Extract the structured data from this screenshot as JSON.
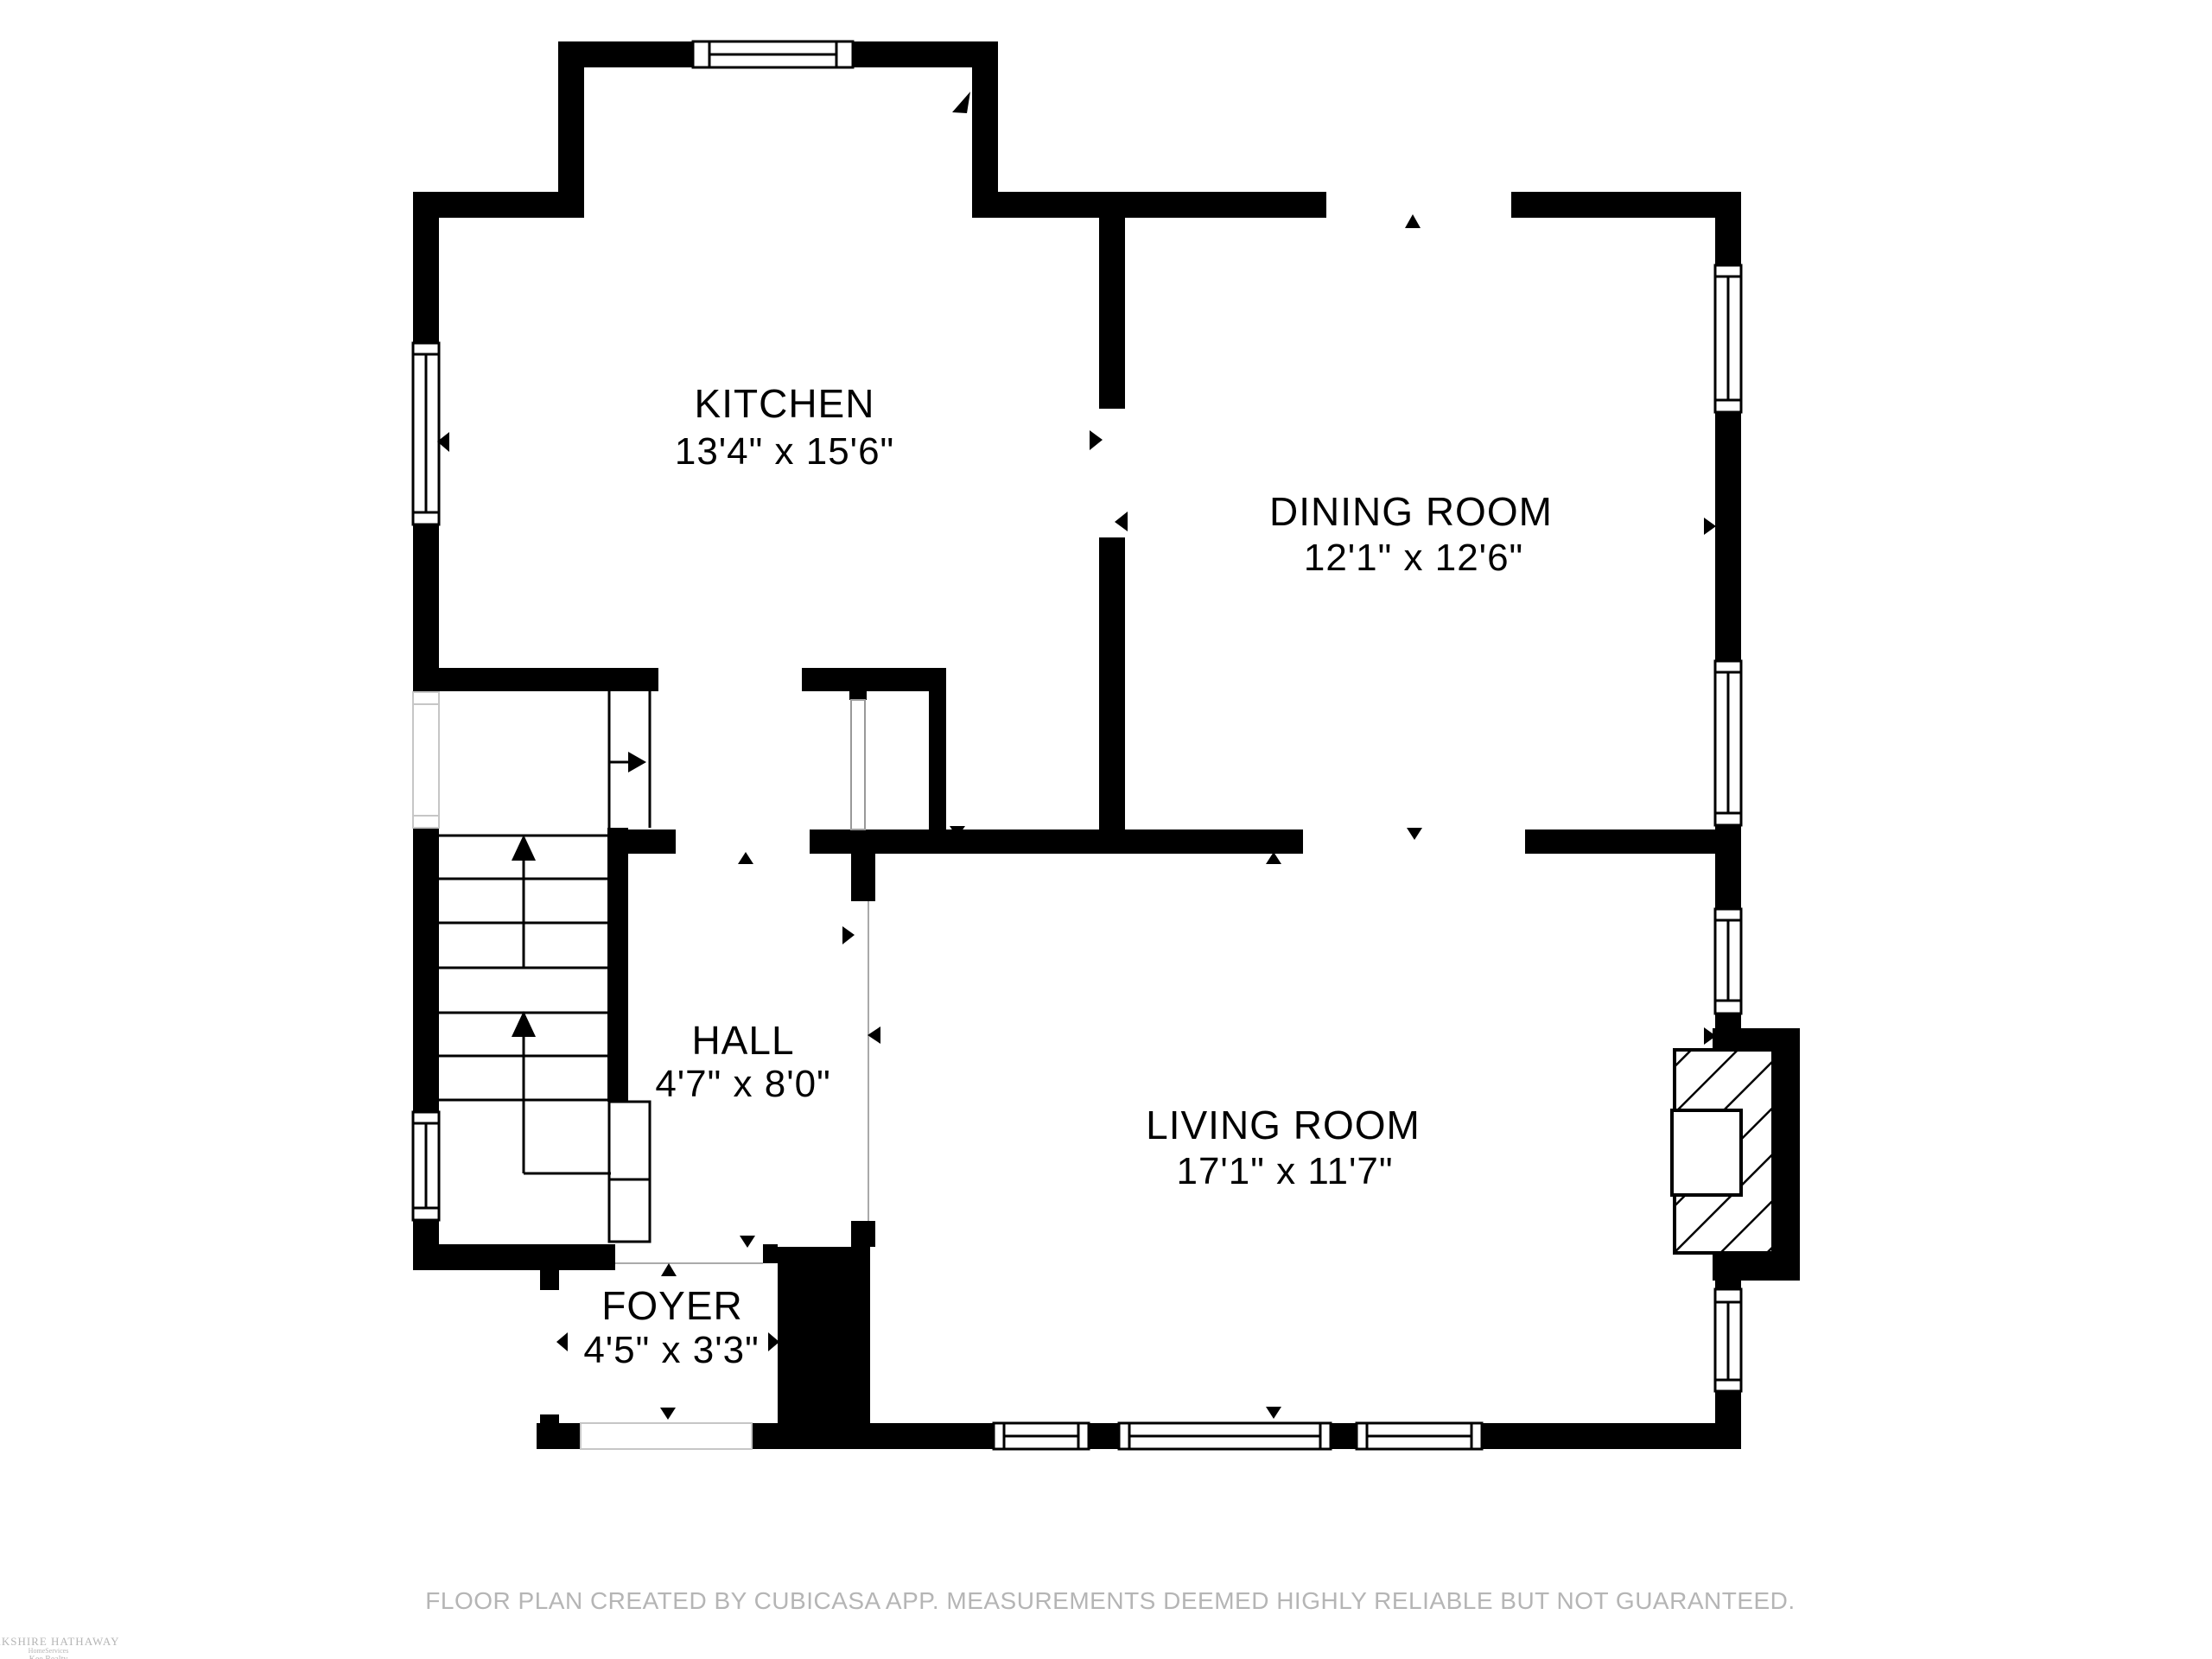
{
  "colors": {
    "background": "#ffffff",
    "walls": "#000000",
    "label_text": "#000000",
    "muted_text": "#b5b5b5",
    "faint_lines": "#c6c6c6"
  },
  "rooms": [
    {
      "id": "kitchen",
      "name": "KITCHEN",
      "dimensions": "13'4\" x 15'6\""
    },
    {
      "id": "dining-room",
      "name": "DINING ROOM",
      "dimensions": "12'1\" x 12'6\""
    },
    {
      "id": "hall",
      "name": "HALL",
      "dimensions": "4'7\" x 8'0\""
    },
    {
      "id": "living-room",
      "name": "LIVING ROOM",
      "dimensions": "17'1\" x 11'7\""
    },
    {
      "id": "foyer",
      "name": "FOYER",
      "dimensions": "4'5\" x 3'3\""
    }
  ],
  "footer": {
    "disclaimer": "FLOOR PLAN CREATED BY CUBICASA APP. MEASUREMENTS DEEMED HIGHLY RELIABLE BUT NOT GUARANTEED."
  },
  "logo": {
    "line1": "BERKSHIRE HATHAWAY",
    "line2": "HomeServices",
    "line3": "Kee Realty"
  }
}
